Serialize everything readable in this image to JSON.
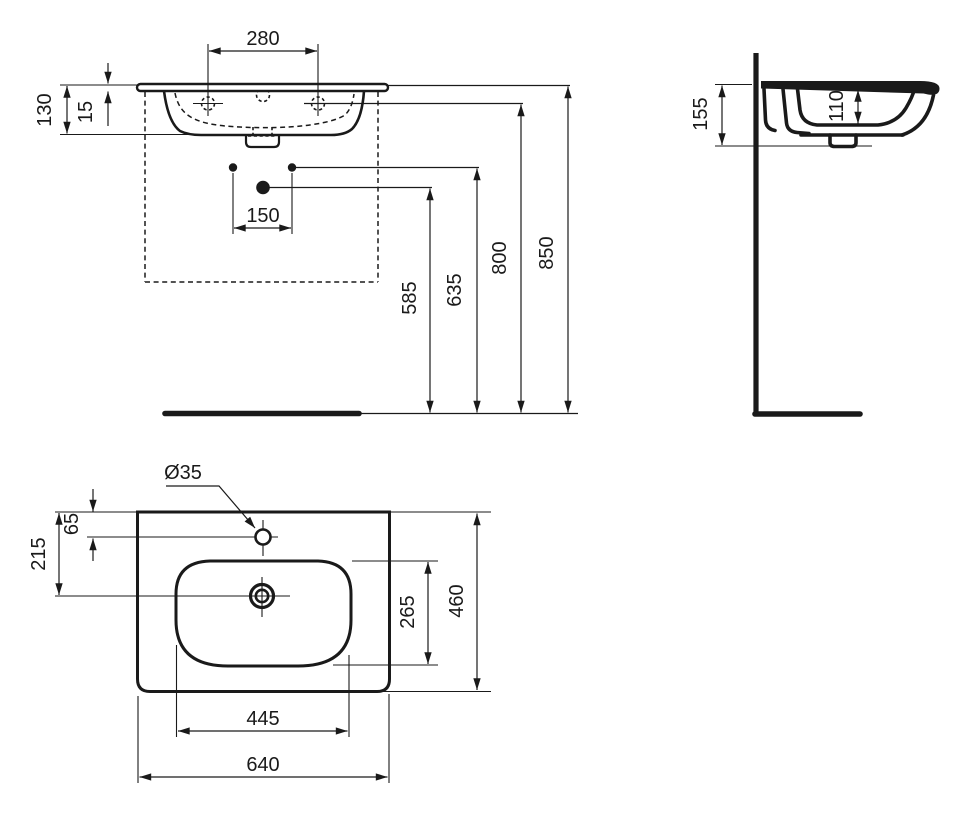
{
  "drawing": {
    "type": "washbasin technical dimension drawing",
    "background": "#ffffff",
    "line_color": "#1a1a1a",
    "front_view": {
      "dims": {
        "faucet_hole_spacing": "280",
        "front_height": "130",
        "rim_thickness": "15",
        "supply_spacing": "150",
        "waste_outlet_height": "585",
        "supply_height": "635",
        "faucet_deck_height": "800",
        "rim_height": "850"
      }
    },
    "side_view": {
      "dims": {
        "overall_height": "155",
        "bowl_inner_depth": "110"
      }
    },
    "plan_view": {
      "dims": {
        "faucet_hole_diameter": "Ø35",
        "faucet_hole_offset": "65",
        "drain_offset": "215",
        "bowl_front_to_back": "265",
        "overall_front_to_back": "460",
        "bowl_width": "445",
        "overall_width": "640"
      }
    }
  }
}
